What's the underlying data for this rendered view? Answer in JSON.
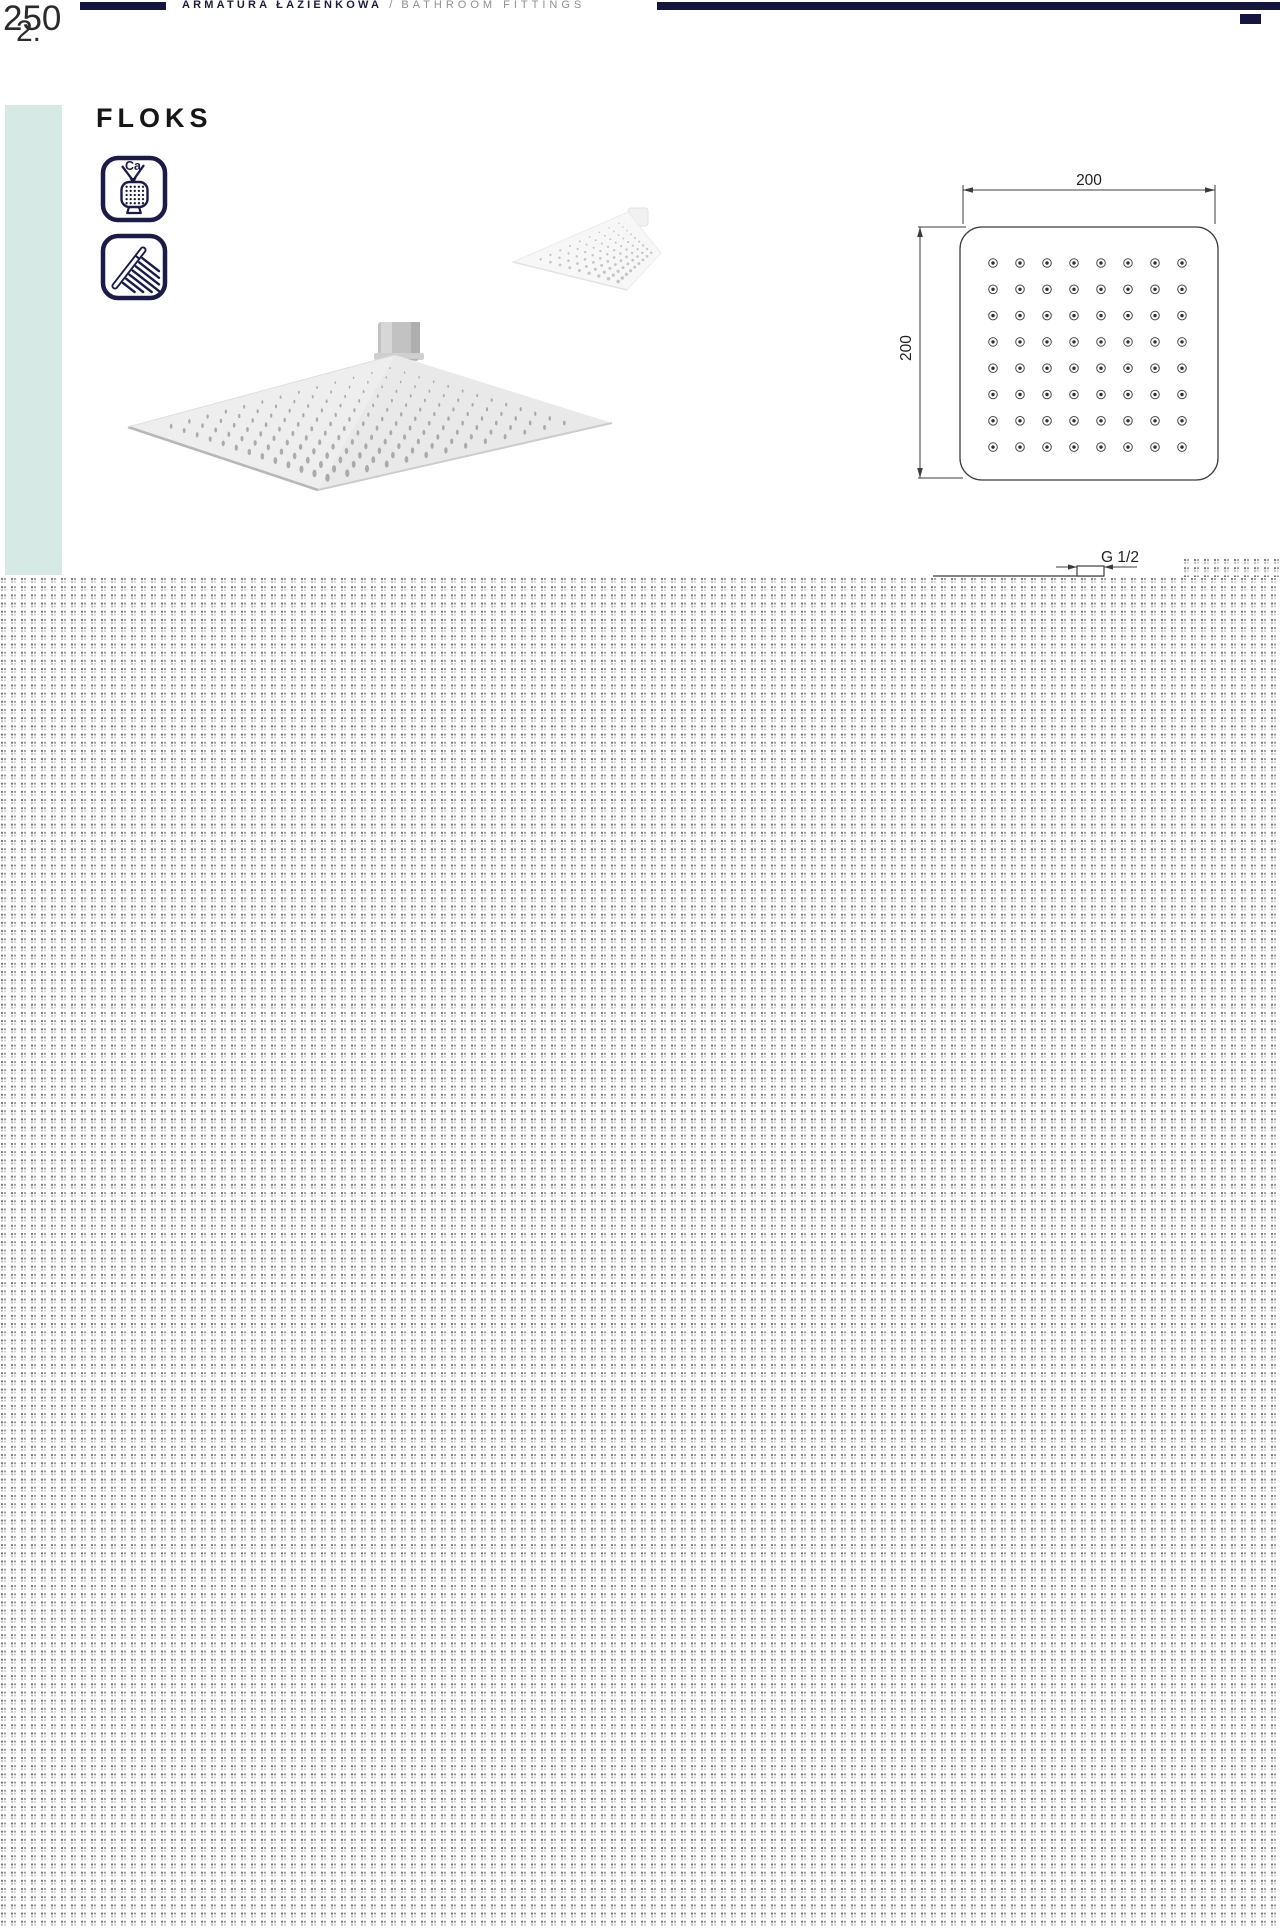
{
  "page": {
    "number": "250",
    "number_fragment": "2.",
    "header": {
      "title_pl": "ARMATURA ŁAZIENKOWA",
      "separator": "/",
      "title_en": "BATHROOM FITTINGS"
    }
  },
  "product": {
    "name": "FLOKS",
    "feature_icons": [
      {
        "name": "anti-limescale",
        "label": "Ca"
      },
      {
        "name": "hand-shower",
        "label": ""
      }
    ]
  },
  "diagram": {
    "width_label": "200",
    "height_label": "200",
    "thread_label": "G 1/2"
  },
  "colors": {
    "navy": "#15153d",
    "icon_navy": "#1b1b46",
    "accent_bar": "#d7e9e5",
    "header_gray": "#8f8f8f",
    "drawing_line": "#3c3c3c"
  }
}
